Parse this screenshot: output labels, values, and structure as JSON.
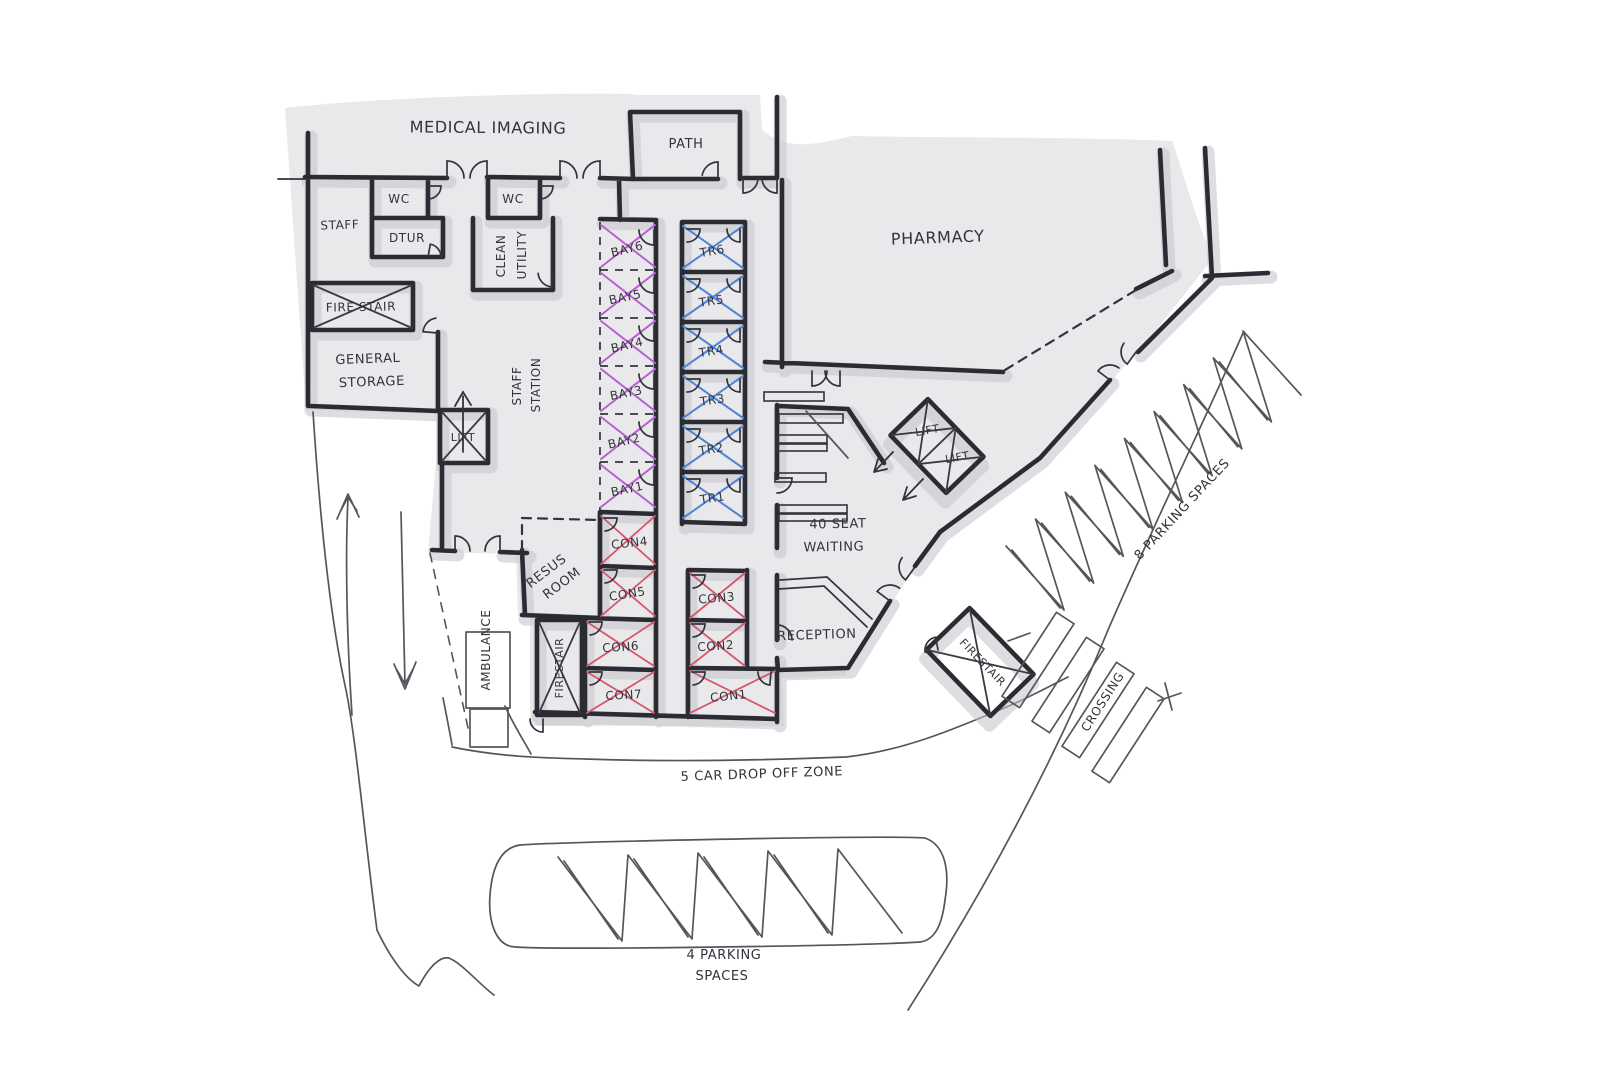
{
  "rooms": {
    "medical_imaging": "MEDICAL IMAGING",
    "path": "PATH",
    "wc_left": "WC",
    "wc_right": "WC",
    "staff": "STAFF",
    "dtur": "DTUR",
    "clean_line1": "CLEAN",
    "clean_line2": "UTILITY",
    "fire_stair": "FIRE STAIR",
    "storage_line1": "GENERAL",
    "storage_line2": "STORAGE",
    "lift": "LIFT",
    "staff_station_line1": "STAFF",
    "staff_station_line2": "STATION",
    "resus_line1": "RESUS",
    "resus_line2": "ROOM",
    "pharmacy": "PHARMACY",
    "waiting_line1": "40 SEAT",
    "waiting_line2": "WAITING",
    "reception": "RECEPTION"
  },
  "bays": [
    "BAY6",
    "BAY5",
    "BAY4",
    "BAY3",
    "BAY2",
    "BAY1"
  ],
  "triage_rooms": [
    "TR6",
    "TR5",
    "TR4",
    "TR3",
    "TR2",
    "TR1"
  ],
  "consult_rooms": [
    "CON4",
    "CON5",
    "CON6",
    "CON7",
    "CON3",
    "CON2",
    "CON1"
  ],
  "circulation": {
    "lift_shaft_1": "LIFT",
    "lift_shaft_2": "LIFT",
    "fire_stair_ambulance": "FIRESTAIR",
    "fire_stair_entry": "FIRESTAIR"
  },
  "site": {
    "ambulance": "AMBULANCE",
    "drop_off": "5 CAR DROP OFF ZONE",
    "crossing": "CROSSING",
    "parking_right": "8 PARKING SPACES",
    "parking_bottom_line1": "4 PARKING",
    "parking_bottom_line2": "SPACES"
  },
  "colors": {
    "wall": "#2b2b33",
    "footprint": "#e9e9ec",
    "shadow": "#c3c3ca",
    "bay_cross": "#b95fd0",
    "triage_cross": "#4f86d6",
    "consult_cross": "#d6566b",
    "pencil": "#55555c"
  }
}
